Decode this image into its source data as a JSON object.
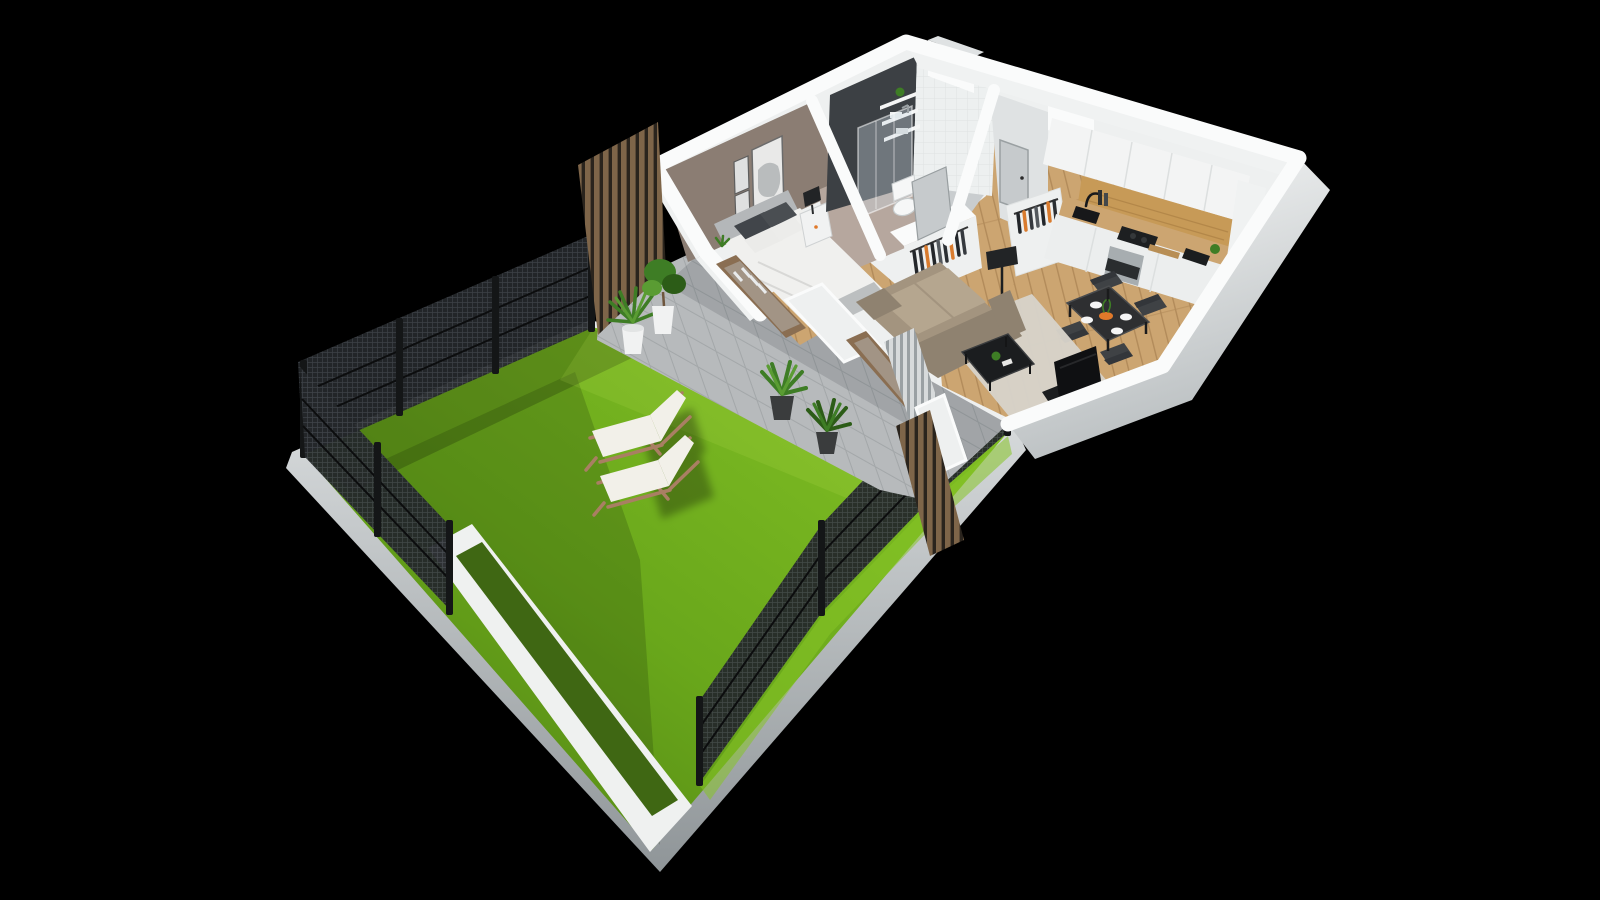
{
  "scene": {
    "title": "3D Apartment Floor Plan",
    "description": "Isometric 3D cutaway render of a one-bedroom apartment with kitchen, dining and living area, bathroom, hallway, paved terrace and a large fenced garden lawn with two sun loungers, on a black background",
    "view": "isometric cutaway, walls cut at half height",
    "background": "#000000"
  },
  "palette": {
    "bg": "#000000",
    "lawn-bright": "#86c426",
    "lawn-mid": "#69a71b",
    "lawn-dark": "#4c7a11",
    "lawn-inset": "#3f6713",
    "tile": "#b7babc",
    "tile-grout": "#a4a8aa",
    "wall-top": "#fafbfb",
    "wall-face": "#eef0f0",
    "wall-shade": "#dfe2e3",
    "wall-dark": "#b9bec0",
    "slab-light": "#e6e9ea",
    "slab-dark": "#8f9598",
    "curb": "#eff1f0",
    "fence-post": "#141617",
    "fence-panel": "#24272a",
    "fence-mesh": "#40444a",
    "slat-brown": "#7e6549",
    "slat-brown-dark": "#2a241d",
    "slat-gray": "#d7dadb",
    "slat-gray-dark": "#9aa0a3",
    "wood-floor": "#cca571",
    "wood-floor-line": "#b28b5a",
    "wood-oak": "#c79a57",
    "wood-frame": "#8a6e52",
    "accent-wall": "#8b7d73",
    "side-wall": "#b6a79e",
    "dark-tile": "#3c4044",
    "white-tile": "#edf0f0",
    "bath-floor": "#c9cdcf",
    "duvet": "#f0f0ee",
    "headboard": "#b4b7b9",
    "pillow-dark": "#41454a",
    "pillow-light": "#ebebe9",
    "bench-gray": "#bcbfc0",
    "sofa": "#a3947f",
    "sofa-light": "#b5a68f",
    "sofa-dark": "#8f8270",
    "rug": "#d7d3c9",
    "table-black": "#2e2f31",
    "chair-dark": "#3f4245",
    "chair-back": "#33363a",
    "console-black": "#1b1d1f",
    "tv-black": "#0f1012",
    "lamp-black": "#222426",
    "plant-green": "#3e7d25",
    "plant-green-light": "#5a9c33",
    "plant-green-dark": "#2c5c17",
    "pot-white": "#f1f2f2",
    "pot-dark": "#3a3c3d",
    "orange-accent": "#e0792a",
    "steel": "#a7adb0",
    "glass": "rgba(205,220,228,0.35)",
    "curtain": "#e9ebec",
    "door-gray": "#c6cacc",
    "lounger-fabric": "#f2f0e9",
    "lounger-frame": "#a97f63",
    "shadow": "rgba(10,14,6,0.30)"
  },
  "garden": {
    "items": [
      "lawn",
      "white curb path with grass inset",
      "two sun loungers",
      "mesh fence with posts (northwest)",
      "mesh fence (southwest)",
      "mesh fence (southeast)",
      "wood slat privacy screen",
      "palm plant in white pot",
      "ficus tree in white pot"
    ],
    "fence_panel_count": 8,
    "sun_lounger_count": 2
  },
  "terrace": {
    "items": [
      "gray ceramic tiles",
      "two potted plants in dark pots",
      "wood slat screens",
      "sliding glass doors"
    ]
  },
  "rooms": [
    {
      "name": "bedroom",
      "furniture": [
        "double bed with white duvet",
        "gray headboard",
        "patterned pillows",
        "nightstand with black lamp",
        "three framed artworks",
        "taupe accent wall",
        "open wardrobe with clothes"
      ]
    },
    {
      "name": "bathroom",
      "furniture": [
        "dark tiled feature wall",
        "white subway tile wall",
        "wall shelves with towels and plant",
        "walk-in glass shower",
        "toilet",
        "bathroom door"
      ]
    },
    {
      "name": "hallway",
      "furniture": [
        "entry door",
        "coat rack with hangers",
        "duct column",
        "black floor lamp"
      ]
    },
    {
      "name": "kitchen",
      "furniture": [
        "white upper cabinets",
        "oak backsplash panel",
        "wooden countertop",
        "black sink with faucet",
        "induction cooktop",
        "built-in oven",
        "counter plant",
        "small appliances"
      ]
    },
    {
      "name": "dining-area",
      "furniture": [
        "black dining table",
        "four dark chairs",
        "white plates",
        "orange fruit bowl"
      ]
    },
    {
      "name": "living-room",
      "furniture": [
        "taupe three-seat sofa",
        "cream rug",
        "black coffee table with plant",
        "TV on black console",
        "sliding glass door"
      ]
    }
  ]
}
